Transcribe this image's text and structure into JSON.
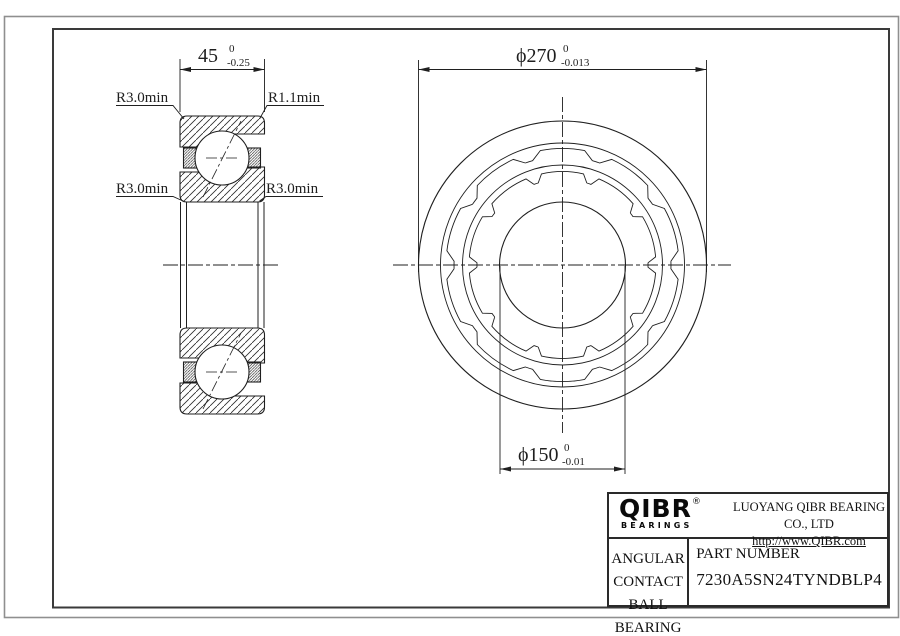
{
  "colors": {
    "line": "#1f1f1f",
    "frame_outer": "#8f8f8f",
    "frame_inner": "#3a3a3a",
    "background": "#ffffff"
  },
  "section_view": {
    "width_dimension": {
      "value": "45",
      "tol_upper": "0",
      "tol_lower": "-0.25"
    },
    "labels": {
      "top_left": "R3.0min",
      "top_right": "R1.1min",
      "bottom_left": "R3.0min",
      "bottom_right": "R3.0min"
    }
  },
  "front_view": {
    "outer_diameter": {
      "value": "ϕ270",
      "tol_upper": "0",
      "tol_lower": "-0.013"
    },
    "bore_diameter": {
      "value": "ϕ150",
      "tol_upper": "0",
      "tol_lower": "-0.01"
    }
  },
  "title_block": {
    "logo_text": "QIBR",
    "logo_registered": "®",
    "logo_subtext": "BEARINGS",
    "company_name": "LUOYANG QIBR BEARING CO., LTD",
    "website": "http://www.QIBR.com",
    "product_line1": "ANGULAR CONTACT",
    "product_line2": "BALL BEARING",
    "part_number_label": "PART NUMBER",
    "part_number": "7230A5SN24TYNDBLP4"
  }
}
